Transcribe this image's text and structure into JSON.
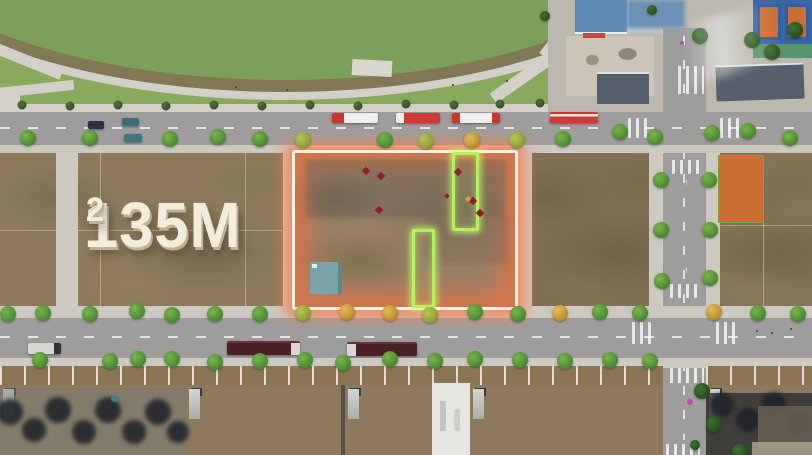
{
  "overlay": {
    "area_label": {
      "value": "135M",
      "exponent": "2"
    }
  },
  "palette": {
    "pond": "#7c9f5b",
    "grass": "#8aa95c",
    "path": "#d2d0c8",
    "sidewalk": "#ccc9c0",
    "road": "#9e9d9b",
    "dirt": "#8d7a5c",
    "plot_border": "#fff3e4",
    "plot_glow": "#f87a4b",
    "highlight_green": "#b5f05f",
    "shed": "#7ba4a8",
    "bus_red": "#cf3a32",
    "truck_dark": "#4a2024",
    "court_orange": "#c96f35",
    "court_blue": "#3a66a8",
    "roof_slate": "#55606a",
    "roof_white": "#e9e9e5",
    "tree": "#4f8f35",
    "tree_autumn": "#c3922f",
    "marker_red": "#8e1f2c",
    "marker_magenta": "#b34fb3",
    "label_text": "#f4eddc"
  }
}
